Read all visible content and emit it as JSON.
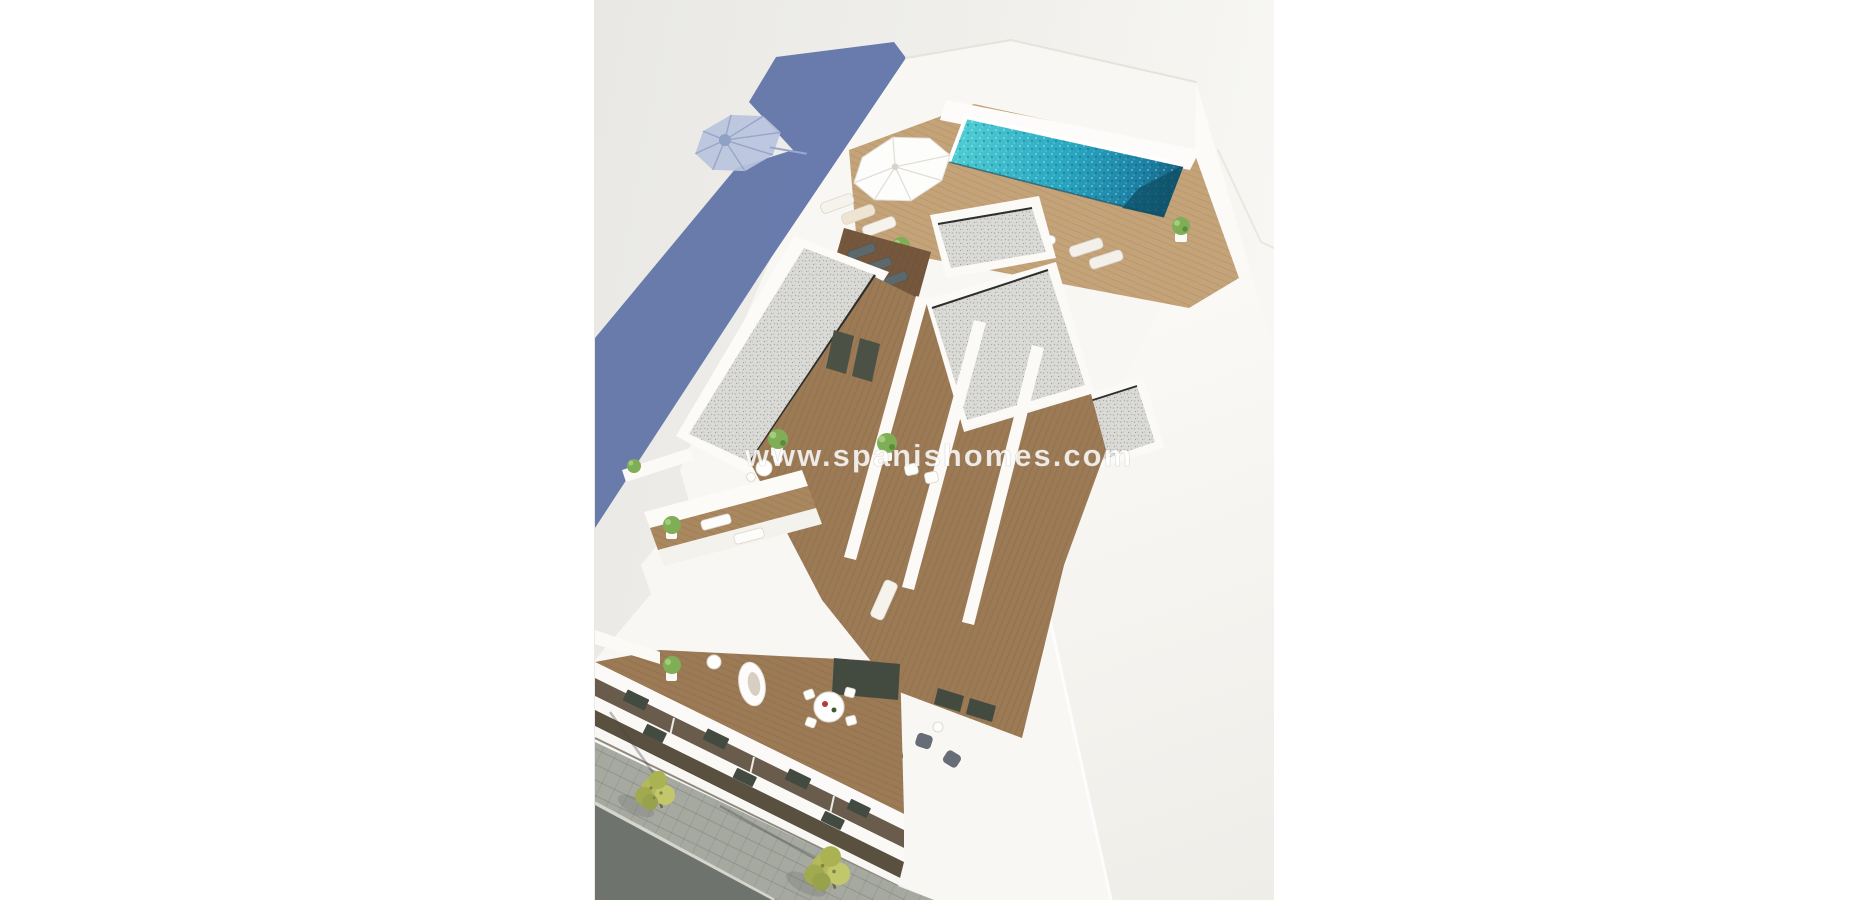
{
  "meta": {
    "type": "architectural-3d-render",
    "subject": "Aerial 3D render of a modern white apartment building with rooftop pool, solarium terraces, balconies and a street corner",
    "canvas_size": "1868x900"
  },
  "watermark": {
    "text": "www.spanishomes.com"
  },
  "colors": {
    "page_background": "#ffffff",
    "ground": "#ecebe8",
    "shadow_blue": "#6276a9",
    "umbrella_shadow": "#b9c3dd",
    "umbrella_shadow_rib": "#93a2c7",
    "pool_turquoise": "#2fb0c6",
    "pool_deep": "#15607f",
    "deck_wood": "#c4a379",
    "terrace_wood": "#9b7a55",
    "shaded_deck_wood": "#75573d",
    "gravel": "#dadad7",
    "building_white": "#f8f7f3",
    "asphalt": "#6f736d",
    "sidewalk": "#a6a9a0",
    "curb": "#d5d5cd",
    "tree_foliage": "#b3b95c",
    "furniture_white": "#fdfdfb",
    "armchair_gray": "#666d76",
    "window_dark": "#434a40",
    "door_dark": "#4b5144",
    "table_accent_red": "#b33a35"
  },
  "scene": {
    "elements": [
      "blue building shadow with parasol silhouette on ground",
      "rooftop swimming pool with sparkling water",
      "pool sun deck with white parasol and sun loungers",
      "gravel flat roofs with white parapets",
      "penthouse terraces with potted plants, tables and loungers",
      "lower balconies with round dining table and armchairs",
      "white balcony slab facade",
      "street corner with sidewalk, curb and two trees"
    ]
  }
}
